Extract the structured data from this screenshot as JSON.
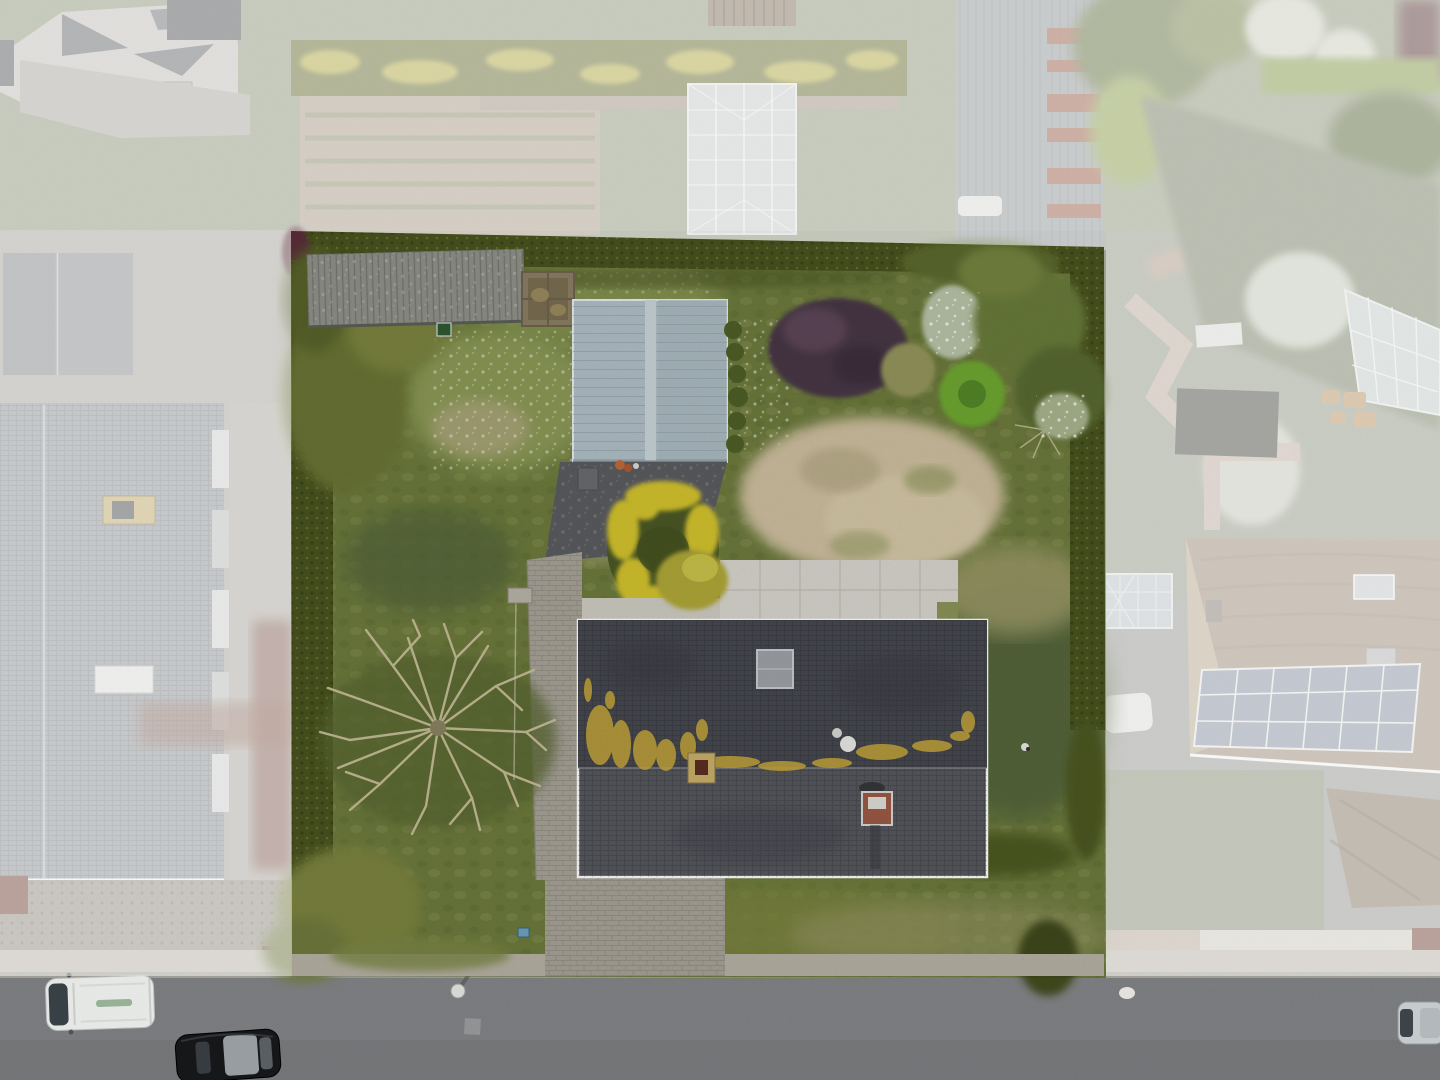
{
  "meta": {
    "title": "Aerial drone photo of a property with highlighted parcel",
    "type": "aerial-photograph",
    "width": 1440,
    "height": 1080
  },
  "scene": {
    "highlight": {
      "label": "highlighted property parcel",
      "overlay_color": "#ffffff",
      "overlay_opacity": "0.53"
    },
    "objects": [
      {
        "name": "parcel",
        "label": "highlighted garden parcel"
      },
      {
        "name": "main-house-roof",
        "label": "dark tiled gable roof of main house"
      },
      {
        "name": "blue-shed",
        "label": "light blue-gray gabled garden shed"
      },
      {
        "name": "gray-shed",
        "label": "gray corrugated storage shed"
      },
      {
        "name": "wood-pen",
        "label": "wooden compost pen"
      },
      {
        "name": "brick-driveway",
        "label": "brick paver driveway"
      },
      {
        "name": "asphalt-apron",
        "label": "asphalt apron in front of shed"
      },
      {
        "name": "white-patio",
        "label": "white concrete patio"
      },
      {
        "name": "sand-patch",
        "label": "bare sandy patch in lawn"
      },
      {
        "name": "yellow-flower-island",
        "label": "yellow flowering shrub island"
      },
      {
        "name": "purple-bush",
        "label": "purple smoke bush"
      },
      {
        "name": "bare-tree",
        "label": "large leafless tree"
      },
      {
        "name": "road",
        "label": "asphalt street"
      },
      {
        "name": "white-van",
        "label": "white van parked on street"
      },
      {
        "name": "black-car",
        "label": "black car on street"
      },
      {
        "name": "silver-car",
        "label": "silver car at right edge"
      },
      {
        "name": "solar-roof-house",
        "label": "neighbor house with solar panels (faded)"
      },
      {
        "name": "greenhouse",
        "label": "neighbor greenhouse (faded)"
      },
      {
        "name": "barn",
        "label": "neighbor barn with rusty roof (faded)"
      },
      {
        "name": "left-house-roof",
        "label": "neighbor gray tiled roof (faded)"
      },
      {
        "name": "top-left-house",
        "label": "neighbor white hip roof house (faded)"
      }
    ],
    "colors": {
      "road": "#85878a",
      "road_dark": "#7b7d80",
      "sidewalk": "#c3beb2",
      "parcel_sidewalk": "#b7b2a5",
      "grass_base": "#6d7b3d",
      "grass_light": "#8c9a57",
      "grass_dark": "#55663a",
      "grass_dry": "#9a9868",
      "sand": "#cfc0a0",
      "sand_dark": "#b3a883",
      "hedge": "#49531f",
      "hedge_light": "#7a7c2e",
      "tree_olive": "#6b7434",
      "tree_yellowgreen": "#7c8440",
      "house_roof_upper": "#474950",
      "house_roof_lower": "#56585e",
      "lichen": "#c9a93c",
      "skylight": "#9fa3a8",
      "chimney_yellow": "#c9b06a",
      "chimney_red": "#9c5a46",
      "shed_blue": "#b1c0c7",
      "shed_blue_ridge": "#c9d6da",
      "shed_gray": "#90928a",
      "wood_pen": "#8c7f63",
      "asphalt_apron": "#5c5d61",
      "driveway_brick": "#a7a399",
      "patio": "#d8d6ce",
      "patio_light": "#cfccc2",
      "flowers_yellow": "#d3c32f",
      "flower_bed_center": "#4c5826",
      "bush_purple": "#4a3947",
      "shrub_olive": "#94955c",
      "bush_blossom": "#b9c4a8",
      "shrub_bright": "#6fa832",
      "bare_branches": "#cbc19c",
      "van": "#eef0ee",
      "car_black": "#17181a",
      "car_silver": "#cdd2d4",
      "glass": "#aab0b4",
      "faded_lawn": "#97a083",
      "faded_pave": "#b0aca4",
      "faded_roof_gray": "#94999d",
      "faded_roof_small": "#8f9398",
      "faded_barn": "#9aa0a2",
      "rust": "#a85a40",
      "faded_house_white": "#cfc9c4",
      "faded_patio": "#b4b0a8",
      "garden_beds": "#b2a58f",
      "hedge_band": "#6d7232",
      "hedge_yellow": "#c9bf4a",
      "greenhouse": "#d4d9d8",
      "pergola": "#8a7660",
      "lawn_sage": "#7a8468",
      "path_pink": "#c8b4a6",
      "conservatory": "#cfd6d4",
      "bed_dark": "#4a4a42",
      "wicker": "#c29a66",
      "solar_roof": "#a5947e",
      "solar_panels": "#8e97a8",
      "solar_facade": "#c2b096",
      "roof_brown_low": "#8f7e6a",
      "drive_right": "#9d9d99",
      "concrete_white": "#d9d6cc",
      "hedge_red": "#7a4438",
      "gravel": "#9b9488",
      "blossom_white": "#d9ddcc",
      "tree_darkred": "#5c3434"
    }
  }
}
